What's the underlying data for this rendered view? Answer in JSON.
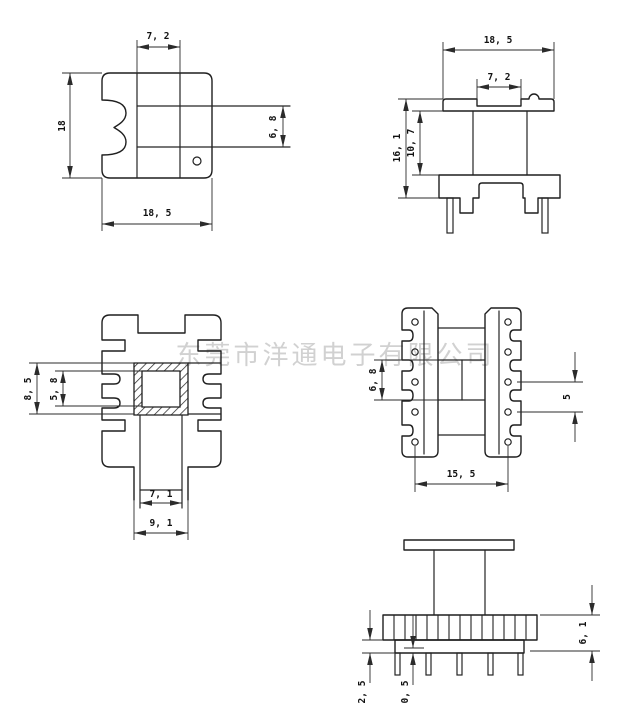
{
  "watermark": {
    "text": "东莞市洋通电子有限公司"
  },
  "colors": {
    "line": "#1f1f1f",
    "dim_text": "#111111",
    "watermark": "#c6c6c6",
    "background": "#ffffff"
  },
  "views": {
    "front": {
      "dim_window_width": "7, 2",
      "dim_height": "18",
      "dim_window_height": "6, 8",
      "dim_width": "18, 5"
    },
    "side": {
      "dim_flange_width": "18, 5",
      "dim_notch_width": "7, 2",
      "dim_total_height": "16, 1",
      "dim_winding_height": "10, 7"
    },
    "section": {
      "dim_tube_outer": "8, 5",
      "dim_tube_inner": "5, 8",
      "dim_channel_inner": "7, 1",
      "dim_channel_outer": "9, 1"
    },
    "bottom": {
      "dim_window": "6, 8",
      "dim_pin_pitch": "5",
      "dim_pin_row_span": "15, 5"
    },
    "profile": {
      "dim_flange_height": "6, 1",
      "dim_base_height": "2, 5",
      "dim_step": "0, 5"
    }
  }
}
